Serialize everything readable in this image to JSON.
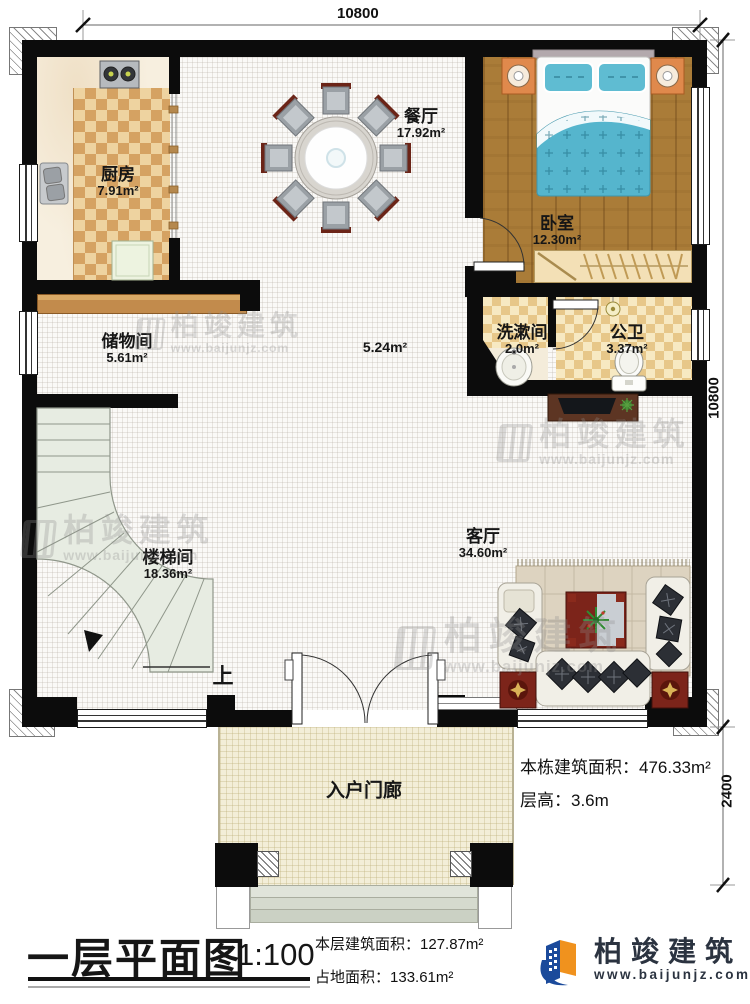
{
  "dimensions": {
    "top": "10800",
    "right_upper": "10800",
    "right_lower": "2400"
  },
  "rooms": [
    {
      "name": "厨房",
      "area": "7.91m²"
    },
    {
      "name": "餐厅",
      "area": "17.92m²"
    },
    {
      "name": "卧室",
      "area": "12.30m²"
    },
    {
      "name": "储物间",
      "area": "5.61m²"
    },
    {
      "name": "洗漱间",
      "area": "2.0m²"
    },
    {
      "name": "公卫",
      "area": "3.37m²"
    },
    {
      "name": "楼梯间",
      "area": "18.36m²"
    },
    {
      "name": "客厅",
      "area": "34.60m²"
    },
    {
      "name": "入户门廊",
      "area": ""
    }
  ],
  "annotations": {
    "hall_area": "5.24m²",
    "stairs_up": "上"
  },
  "info_block": {
    "building_area_label": "本栋建筑面积：",
    "building_area_value": "476.33m²",
    "floor_height_label": "层高：",
    "floor_height_value": "3.6m"
  },
  "title_block": {
    "title": "一层平面图",
    "scale": "1:100",
    "floor_area_label": "本层建筑面积：",
    "floor_area_value": "127.87m²",
    "land_area_label": "占地面积：",
    "land_area_value": "133.61m²"
  },
  "brand": {
    "name": "柏竣建筑",
    "website": "www.baijunjz.com"
  },
  "watermark": {
    "name": "柏竣建筑",
    "website": "www.baijunjz.com"
  }
}
